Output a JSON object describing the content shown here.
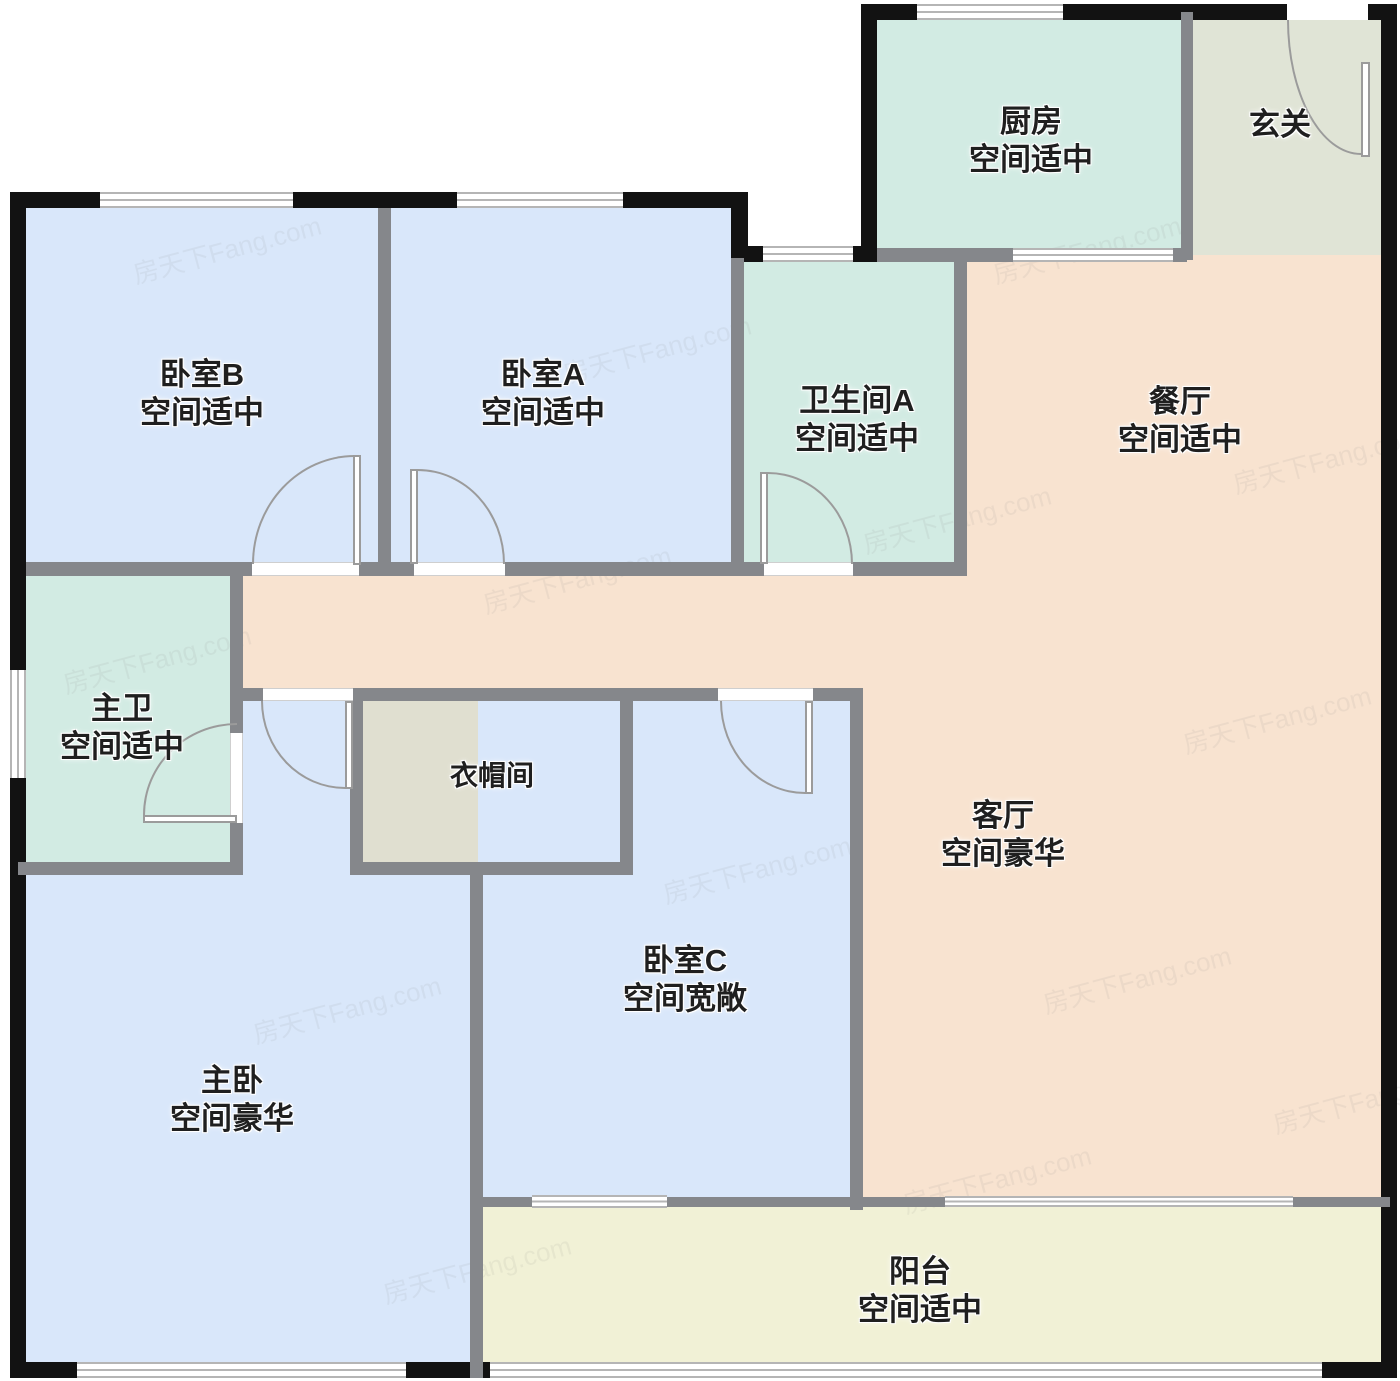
{
  "plan": {
    "watermark_text": "房天下Fang.com",
    "colors": {
      "bedroom": "#d9e7fa",
      "bathroom": "#d2ebe3",
      "kitchen": "#d2ebe3",
      "entry": "#e0e4d6",
      "hall": "#f8e3d0",
      "closet": "#e0dfd0",
      "balcony": "#f1f1d6",
      "wall_exterior": "#121212",
      "wall_interior": "#85878b",
      "door_arc": "#9b9b9b",
      "window_line": "#b5b5b5",
      "label_text": "#1f1f1f"
    },
    "rooms": [
      {
        "id": "kitchen",
        "name": "厨房",
        "size_note": "空间适中"
      },
      {
        "id": "entry",
        "name": "玄关",
        "size_note": ""
      },
      {
        "id": "bedroom-b",
        "name": "卧室B",
        "size_note": "空间适中"
      },
      {
        "id": "bedroom-a",
        "name": "卧室A",
        "size_note": "空间适中"
      },
      {
        "id": "bathroom-a",
        "name": "卫生间A",
        "size_note": "空间适中"
      },
      {
        "id": "dining",
        "name": "餐厅",
        "size_note": "空间适中"
      },
      {
        "id": "master-bath",
        "name": "主卫",
        "size_note": "空间适中"
      },
      {
        "id": "closet",
        "name": "衣帽间",
        "size_note": ""
      },
      {
        "id": "living",
        "name": "客厅",
        "size_note": "空间豪华"
      },
      {
        "id": "bedroom-c",
        "name": "卧室C",
        "size_note": "空间宽敞"
      },
      {
        "id": "master-bedroom",
        "name": "主卧",
        "size_note": "空间豪华"
      },
      {
        "id": "balcony",
        "name": "阳台",
        "size_note": "空间适中"
      }
    ]
  }
}
